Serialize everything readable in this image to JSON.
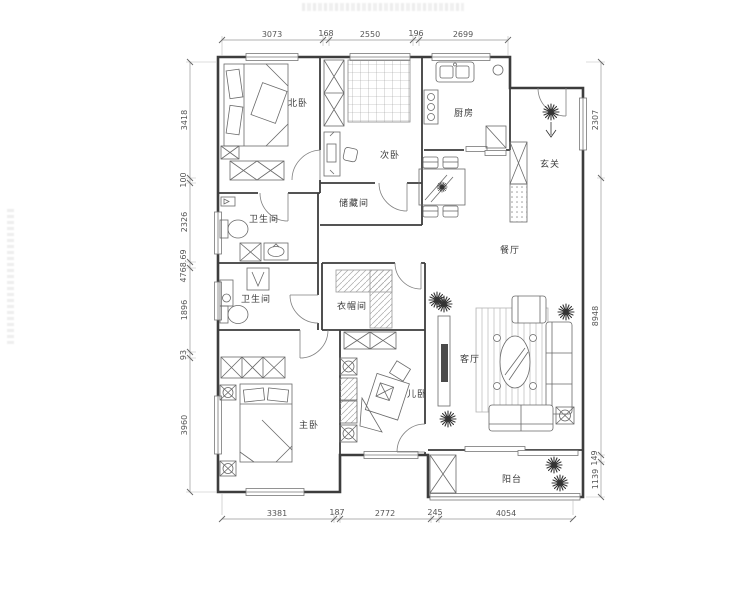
{
  "rooms": {
    "north_bedroom": "北卧",
    "second_bedroom": "次卧",
    "storage": "储藏间",
    "kitchen": "厨房",
    "entry": "玄关",
    "bath1": "卫生间",
    "bath2": "卫生间",
    "dining": "餐厅",
    "cloakroom": "衣帽间",
    "living": "客厅",
    "master_bedroom": "主卧",
    "kids_bedroom": "儿卧",
    "balcony": "阳台"
  },
  "dimensions": {
    "top": [
      "3073",
      "168",
      "2550",
      "196",
      "2699"
    ],
    "left": [
      "3418",
      "100",
      "2326",
      "4768.69",
      "1896",
      "93",
      "3960"
    ],
    "right": [
      "2307",
      "8948",
      "149",
      "1139"
    ],
    "bottom": [
      "3381",
      "187",
      "2772",
      "245",
      "4054"
    ]
  }
}
